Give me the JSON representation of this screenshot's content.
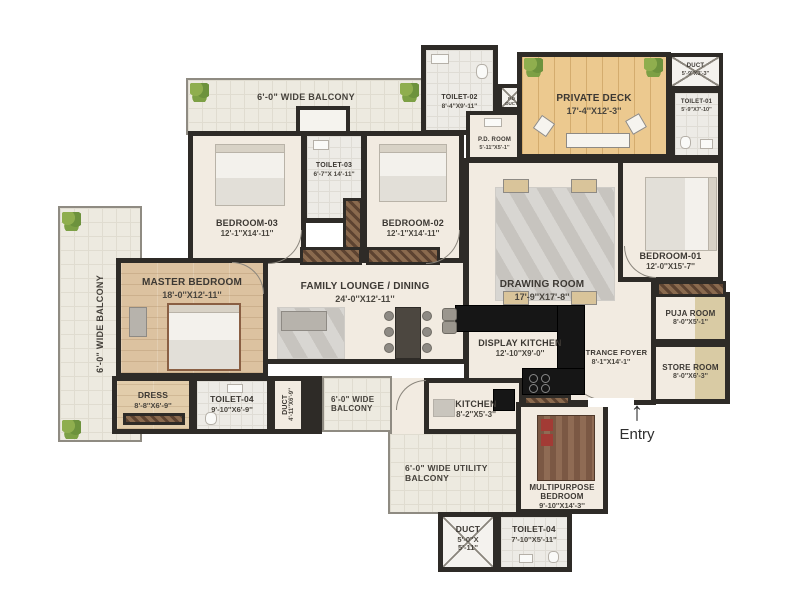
{
  "plan": {
    "entry": {
      "label": "Entry",
      "arrow": "↑"
    },
    "balconies": {
      "top": "6'-0\" WIDE BALCONY",
      "left": "6'-0\" WIDE BALCONY",
      "mid": "6'-0\" WIDE BALCONY",
      "utility": "6'-0\" WIDE UTILITY BALCONY"
    },
    "rooms": {
      "bedroom3": {
        "name": "BEDROOM-03",
        "dims": "12'-1''X14'-11''"
      },
      "toilet3": {
        "name": "TOILET-03",
        "dims": "6'-7''X 14'-11''"
      },
      "bedroom2": {
        "name": "BEDROOM-02",
        "dims": "12'-1''X14'-11''"
      },
      "toilet2": {
        "name": "TOILET-02",
        "dims": "8'-4''X9'-11''"
      },
      "pd_duct": {
        "name": "P.D DUCT"
      },
      "pd_room": {
        "name": "P.D. ROOM",
        "dims": "5'-11''X5'-1''"
      },
      "private_deck": {
        "name": "PRIVATE DECK",
        "dims": "17'-4''X12'-3''"
      },
      "duct_top": {
        "name": "DUCT",
        "dims": "5'-9''X3'-3''"
      },
      "toilet1": {
        "name": "TOILET-01",
        "dims": "5'-9''X7'-10''"
      },
      "bedroom1": {
        "name": "BEDROOM-01",
        "dims": "12'-0''X15'-7''"
      },
      "drawing_room": {
        "name": "DRAWING ROOM",
        "dims": "17'-9''X17'-8''"
      },
      "family_lounge": {
        "name": "FAMILY LOUNGE / DINING",
        "dims": "24'-0''X12'-11''"
      },
      "master_bedroom": {
        "name": "MASTER BEDROOM",
        "dims": "18'-0''X12'-11''"
      },
      "dress": {
        "name": "DRESS",
        "dims": "8'-8''X6'-9''"
      },
      "toilet4_master": {
        "name": "TOILET-04",
        "dims": "9'-10''X6'-9''"
      },
      "duct_master": {
        "name": "DUCT",
        "dims": "4'-11''X6'-9''"
      },
      "display_kitchen": {
        "name": "DISPLAY KITCHEN",
        "dims": "12'-10''X9'-0''"
      },
      "kitchen": {
        "name": "KITCHEN",
        "dims": "8'-2''X5'-3''"
      },
      "entrance_foyer": {
        "name": "ENTRANCE FOYER",
        "dims": "8'-1''X14'-1''"
      },
      "puja_room": {
        "name": "PUJA ROOM",
        "dims": "8'-0''X5'-1''"
      },
      "store_room": {
        "name": "STORE ROOM",
        "dims": "8'-0''X6'-3''"
      },
      "multipurpose_bedroom": {
        "name": "MULTIPURPOSE BEDROOM",
        "dims": "9'-10''X14'-3''"
      },
      "duct_bottom": {
        "name": "DUCT",
        "dims": "5'-0''X 5'-11''"
      },
      "toilet4_bottom": {
        "name": "TOILET-04",
        "dims": "7'-10''X5'-11''"
      }
    },
    "colors": {
      "wall": "#2e2b27",
      "floor_cream": "#f2ebe1",
      "balcony_tile": "#edeae0",
      "wood_floor": "#dcc2a0",
      "deck_wood": "#ecc98f",
      "counter_black": "#161616",
      "wardrobe_brown": "#7a5b42",
      "plant_green": "#7da045"
    }
  }
}
